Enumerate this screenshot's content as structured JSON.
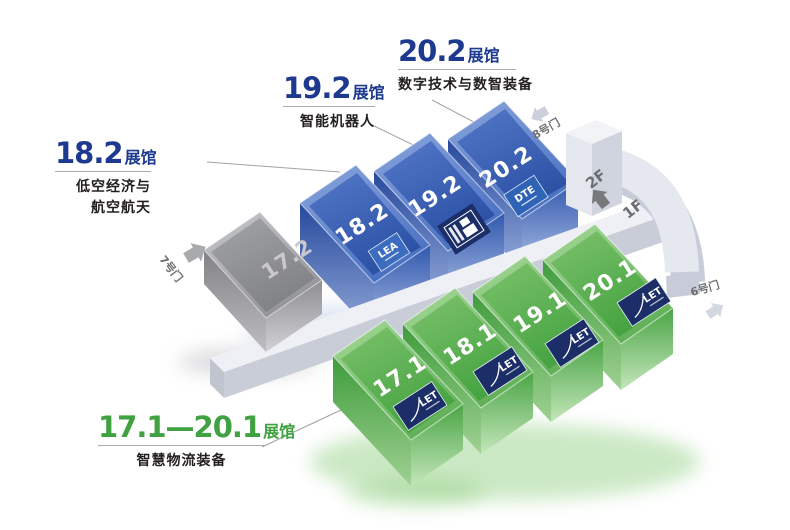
{
  "map": {
    "callouts": {
      "c202": {
        "number": "20.2",
        "hall_word": "展馆",
        "subtitle": "数字技术与数智装备"
      },
      "c192": {
        "number": "19.2",
        "hall_word": "展馆",
        "subtitle": "智能机器人"
      },
      "c182": {
        "number": "18.2",
        "hall_word": "展馆",
        "subtitle_line1": "低空经济与",
        "subtitle_line2": "航空航天"
      },
      "c171_201": {
        "number": "17.1—20.1",
        "hall_word": "展馆",
        "subtitle": "智慧物流装备"
      }
    },
    "halls": {
      "h17_2": {
        "label": "17.2"
      },
      "h18_2": {
        "label": "18.2",
        "logo": "LEA"
      },
      "h19_2": {
        "label": "19.2"
      },
      "h20_2": {
        "label": "20.2",
        "logo": "DTE"
      },
      "h17_1": {
        "label": "17.1",
        "logo": "LET"
      },
      "h18_1": {
        "label": "18.1",
        "logo": "LET"
      },
      "h19_1": {
        "label": "19.1",
        "logo": "LET"
      },
      "h20_1": {
        "label": "20.1",
        "logo": "LET"
      }
    },
    "doors": {
      "door6": "6号门",
      "door7": "7号门",
      "door8": "8号门"
    },
    "floors": {
      "f2": "2F",
      "f1": "1F"
    },
    "colors": {
      "title_blue": "#1d3a8f",
      "title_green": "#3fa13f",
      "hall_blue": "#3a61b5",
      "hall_green": "#54a74c",
      "hall_gray": "#939497",
      "badge_navy": "#1c2e68",
      "badge_blue": "#2f63b6",
      "walkway_gray": "#e5e8ef"
    }
  }
}
